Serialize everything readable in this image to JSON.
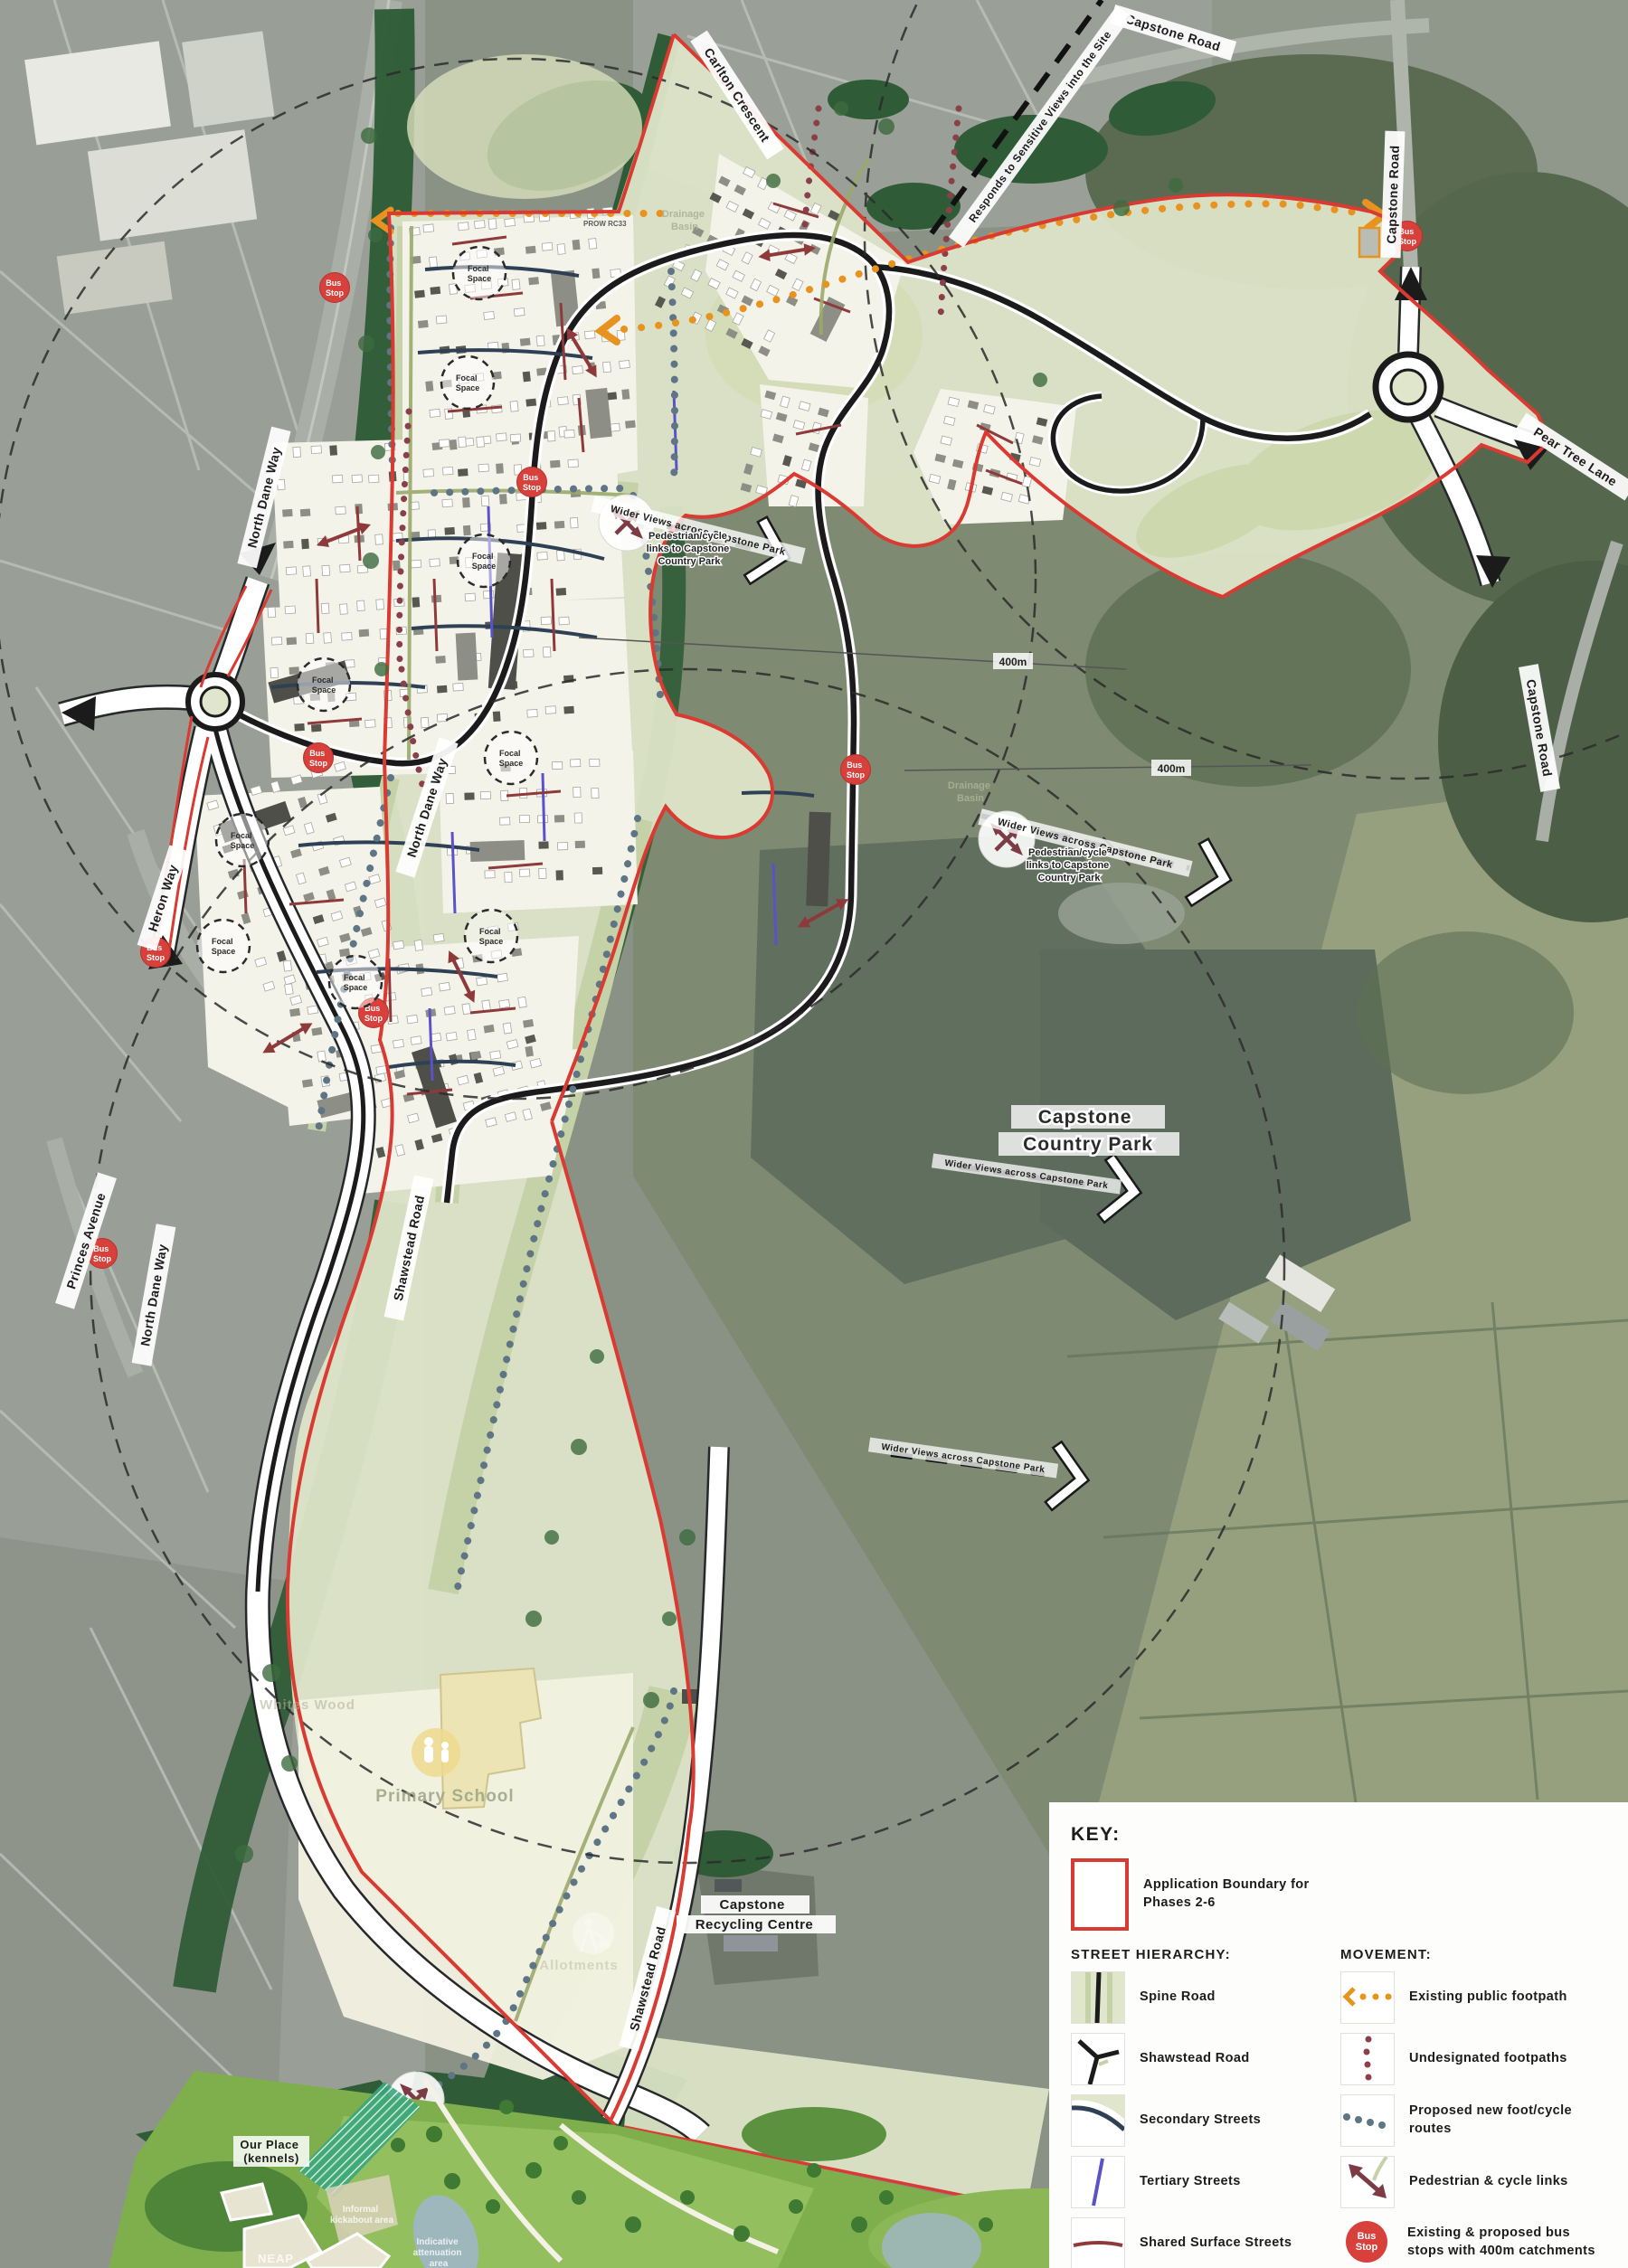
{
  "map_labels": {
    "carlton_crescent": "Carlton Crescent",
    "capstone_road": "Capstone Road",
    "pear_tree_lane": "Pear Tree Lane",
    "north_dane_way": "North Dane Way",
    "heron_way": "Heron Way",
    "princes_avenue": "Princes Avenue",
    "shawstead_road": "Shawstead Road",
    "responds_to_views": "Responds to Sensitive Views into the Site",
    "wider_views": "Wider Views across Capstone Park",
    "prow": "PROW RC33",
    "distance_400m": "400m",
    "capstone_country_park": {
      "line1": "Capstone",
      "line2": "Country Park"
    },
    "recycling_centre": {
      "line1": "Capstone",
      "line2": "Recycling Centre"
    },
    "primary_school": "Primary School",
    "allotments": "Allotments",
    "whites_wood": "Whites Wood",
    "our_place": {
      "line1": "Our Place",
      "line2": "(kennels)"
    },
    "neap": "NEAP",
    "attenuation": {
      "line1": "Indicative",
      "line2": "attenuation",
      "line3": "area"
    },
    "kickabout": {
      "line1": "Informal",
      "line2": "kickabout area"
    },
    "drainage_basin": {
      "line1": "Drainage",
      "line2": "Basin"
    },
    "ped_cycle_links": {
      "line1": "Pedestrian/cycle",
      "line2": "links to Capstone",
      "line3": "Country Park"
    },
    "bus_stop": {
      "line1": "Bus",
      "line2": "Stop"
    },
    "focal_space": {
      "line1": "Focal",
      "line2": "Space"
    }
  },
  "legend": {
    "title": "KEY:",
    "boundary": {
      "line1": "Application Boundary for",
      "line2": "Phases 2-6"
    },
    "street_hierarchy_title": "STREET HIERARCHY:",
    "movement_title": "MOVEMENT:",
    "street_items": [
      "Spine Road",
      "Shawstead Road",
      "Secondary Streets",
      "Tertiary Streets",
      "Shared Surface Streets",
      "Green Lanes"
    ],
    "movement_items": [
      "Existing public footpath",
      "Undesignated footpaths",
      "Proposed new foot/cycle routes",
      "Pedestrian & cycle links",
      "Existing & proposed bus stops with 400m catchments"
    ]
  },
  "colors": {
    "boundary_red": "#d93a32",
    "spine_road": "#1b1b1b",
    "secondary_street": "#2e4154",
    "tertiary_street": "#5a52c8",
    "shared_surface": "#8e3a3a",
    "green_lane": "#9aa96b",
    "existing_footpath": "#e8931f",
    "undesignated_footpath": "#8a4048",
    "proposed_route": "#5d7585",
    "bus_stop_red": "#d8403c",
    "site_fill": "#dee5c8",
    "dark_green_buffer": "#2f5c36"
  }
}
